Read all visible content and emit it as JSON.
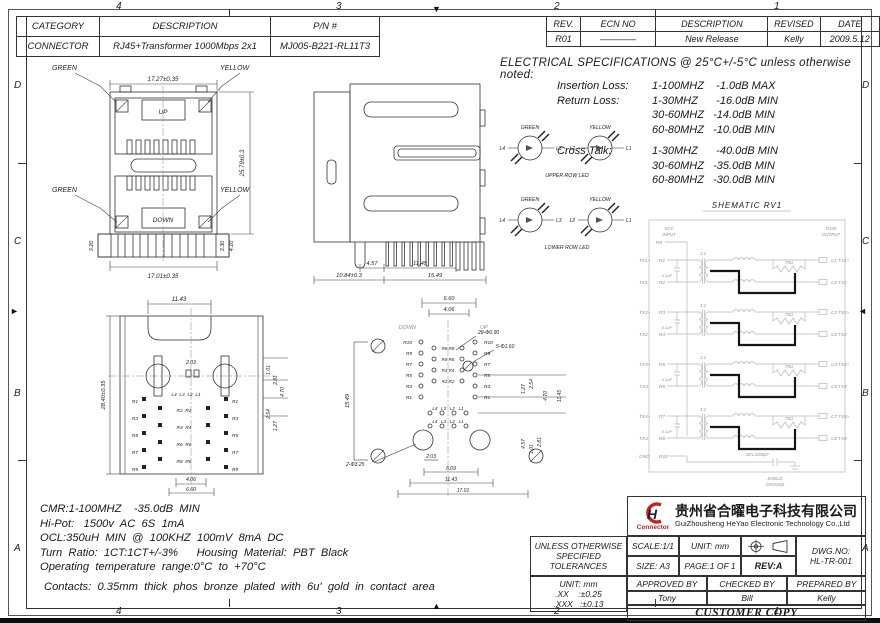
{
  "frame": {
    "zones_h": [
      "4",
      "3",
      "2",
      "1"
    ],
    "zones_v": [
      "D",
      "C",
      "B",
      "A"
    ]
  },
  "part_table": {
    "h": [
      "CATEGORY",
      "DESCRIPTION",
      "P/N #"
    ],
    "r": [
      "CONNECTOR",
      "RJ45+Transformer  1000Mbps  2x1",
      "MJ005-B221-RL11T3"
    ]
  },
  "rev_table": {
    "h": [
      "REV.",
      "ECN NO",
      "DESCRIPTION",
      "REVISED",
      "DATE"
    ],
    "r": [
      "R01",
      "————",
      "New Release",
      "Kelly",
      "2009.5.12"
    ]
  },
  "specs": {
    "title": "ELECTRICAL SPECIFICATIONS @ 25°C+/-5°C unless otherwise noted:",
    "rows": [
      {
        "label": "Insertion Loss:",
        "value": "1-100MHZ    -1.0dB MAX"
      },
      {
        "label": "Return Loss:",
        "value": "1-30MHZ      -16.0dB MIN"
      },
      {
        "label": "",
        "value": "30-60MHZ   -14.0dB MIN"
      },
      {
        "label": "",
        "value": "60-80MHZ   -10.0dB MIN"
      },
      {
        "label": "Cross Talk:",
        "value": "1-30MHZ      -40.0dB MIN"
      },
      {
        "label": "",
        "value": "30-60MHZ   -35.0dB MIN"
      },
      {
        "label": "",
        "value": "60-80MHZ   -30.0dB MIN"
      }
    ]
  },
  "leds": {
    "green": "GREEN",
    "yellow": "YELLOW",
    "l4": "L4",
    "l3": "L3",
    "l2": "L2",
    "l1": "L1",
    "upper": {
      "caption": "UPPER ROW LED"
    },
    "lower": {
      "caption": "LOWER ROW LED"
    }
  },
  "front": {
    "green": "GREEN",
    "yellow": "YELLOW",
    "up": "UP",
    "down": "DOWN",
    "w_top": "17.27±0.35",
    "h_right": "25.79±0.3",
    "w_bot": "17.01±0.35",
    "d1": "3.20",
    "d2": "3.30",
    "d3": "4.10"
  },
  "side": {
    "d1": "4.57",
    "d2": "11.45",
    "d3": "10.84±0.3",
    "d4": "15.49"
  },
  "bottom": {
    "w_top": "11.43",
    "h_left": "28.40±0.35",
    "d_mid": "2.03",
    "r1": "1.01",
    "r2": "2.81",
    "r3": "4.70",
    "r4": "2.54",
    "r5": "1.27",
    "b1": "4.06",
    "b2": "6.60",
    "leds": "L4  L3  L2  L1",
    "pins_left": [
      "R1",
      "R3",
      "R5",
      "R7",
      "R9"
    ],
    "pins_inner": [
      "R2  R2",
      "R4  R4",
      "R6  R6",
      "R8  R8"
    ],
    "pins_right": [
      "R1",
      "R3",
      "R5",
      "R7",
      "R9"
    ]
  },
  "pcb": {
    "down": "DOWN",
    "up": "UP",
    "t1": "6.60",
    "t2": "4.06",
    "left_h": "15.49",
    "holes_small": "28-Φ0.90",
    "holes_mid": "5-Φ1.60",
    "holes_big": "2-Φ3.25",
    "b1": "2.03",
    "b2": "6.09",
    "b3": "11.43",
    "b4": "17.01",
    "rr1": "1.27",
    "rr2": "2.54",
    "rr3": "4.70",
    "rr4": "11.45",
    "rr5": "4.57",
    "rr6": "1.01",
    "rr7": "2.81",
    "rows_outer": [
      "R10",
      "R9",
      "R7",
      "R5",
      "R3",
      "R1"
    ],
    "rows_inner": [
      "R8 R8",
      "R6 R6",
      "R4 R4",
      "R2 R2"
    ],
    "led_row": "L4   L3   L2   L1"
  },
  "schematic": {
    "title": "SHEMATIC RV1",
    "vcc1": "VCC",
    "vcc2": "INPUT",
    "r9": "R9",
    "out1": "RJ45",
    "out2": "OUTPUT",
    "gnd": "GND",
    "r10": "R10",
    "ratio": "1:1",
    "cap": "0.1uF",
    "res": "75Ω",
    "hv_cap": "2KV,1000pF",
    "shield1": "SHIELD",
    "shield2": "GROUND",
    "left_pins": [
      {
        "sig": "TX1+",
        "pin": "R1"
      },
      {
        "sig": "TX1-",
        "pin": "R2"
      },
      {
        "sig": "TX2+",
        "pin": "R3"
      },
      {
        "sig": "TX2-",
        "pin": "R4"
      },
      {
        "sig": "TX3+",
        "pin": "R5"
      },
      {
        "sig": "TX3-",
        "pin": "R6"
      },
      {
        "sig": "TX4+",
        "pin": "R7"
      },
      {
        "sig": "TX4-",
        "pin": "R8"
      }
    ],
    "right_pins": [
      "C1 TX1+",
      "C2 TX1-",
      "C3 TX2+",
      "C6 TX2-",
      "C4 TX3+",
      "C5 TX3-",
      "C7 TX4+",
      "C8 TX4-"
    ]
  },
  "notes": {
    "lines": [
      "CMR:1-100MHZ    -35.0dB  MIN",
      "Hi-Pot:   1500v  AC  6S  1mA",
      "OCL:350uH  MIN  @  100KHZ  100mV  8mA  DC",
      "Turn  Ratio:  1CT:1CT+/-3%      Housing  Material:  PBT  Black",
      "Operating  temperature  range:0°C  to  +70°C"
    ],
    "contacts": "Contacts:  0.35mm  thick  phos  bronze  plated  with  6u'  gold  in  contact  area"
  },
  "titleblock": {
    "company_cn": "贵州省合曜电子科技有限公司",
    "company_en": "GuiZhousheng HeYao Electronic Technology Co.,Ltd",
    "logo_text": "Connector",
    "tol_line1": "UNLESS OTHERWISE",
    "tol_line2": "SPECIFIED TOLERANCES",
    "unit_note": "UNIT: mm",
    "tol_xx": ".XX    :±0.25",
    "tol_xxx": ".XXX   :±0.13",
    "scale": "SCALE:1/1",
    "unit": "UNIT: mm",
    "size": "SIZE: A3",
    "page": "PAGE:1 OF 1",
    "rev": "REV:A",
    "dwg_label": "DWG.NO:",
    "dwg_no": "HL-TR-001",
    "approved_label": "APPROVED BY",
    "checked_label": "CHECKED BY",
    "prepared_label": "PREPARED BY",
    "approved": "Tony",
    "checked": "Bill",
    "prepared": "Kelly",
    "footer": "CUSTOMER COPY"
  }
}
